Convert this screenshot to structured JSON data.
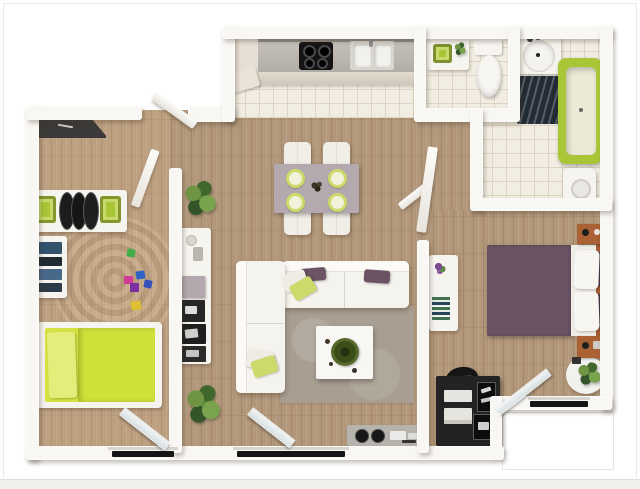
{
  "scene": {
    "kind": "3d-floor-plan-render",
    "description": "Top-down 3D render of a two-bedroom apartment floor plan with lime green and purple accents, wood flooring in living spaces and cream tile in kitchen, bathrooms and hallway. No text labels are rendered in the image.",
    "rooms": [
      {
        "name": "kitchen",
        "floor": "tile",
        "furniture": [
          "tall-cabinet",
          "range-hood",
          "counter",
          "cooktop-4-burner",
          "double-sink"
        ]
      },
      {
        "name": "bathroom-1",
        "floor": "tile",
        "furniture": [
          "vanity",
          "green-basin",
          "small-plant",
          "toilet"
        ]
      },
      {
        "name": "bathroom-2",
        "floor": "tile",
        "furniture": [
          "vanity",
          "round-sink",
          "dark-wave-bathmat",
          "lime-bathtub",
          "washer"
        ]
      },
      {
        "name": "hallway",
        "floor": "tile",
        "furniture": [
          "open-door-leaf",
          "leaning-door-leaf"
        ]
      },
      {
        "name": "living-dining",
        "floor": "wood",
        "furniture": [
          "dining-table",
          "dining-chairs-x4",
          "lime-plates-x4",
          "l-shaped-white-sofa",
          "purple-pillows",
          "lime-pillows",
          "coffee-table",
          "wreath-centerpiece",
          "area-rug",
          "media-console",
          "speakers",
          "shelf-column",
          "plants"
        ]
      },
      {
        "name": "bedroom-1-kids",
        "floor": "wood",
        "furniture": [
          "dark-wardrobe",
          "wall-shelf-green-bins",
          "side-shelf",
          "lime-bed",
          "toy-blocks",
          "round-rug",
          "balcony-glass-door"
        ]
      },
      {
        "name": "bedroom-2-master",
        "floor": "wood",
        "furniture": [
          "purple-double-bed",
          "white-pillows",
          "brown-nightstands",
          "desk",
          "black-dresser",
          "office-chair",
          "round-white-rug",
          "plant",
          "balcony-glass-door"
        ]
      }
    ]
  },
  "palette": {
    "wall": "#f9f7f3",
    "wood": "#b2977a",
    "wood_light": "#bfa385",
    "tile": "#f2ede2",
    "tile_line": "#ddd4c2",
    "lime": "#d5e342",
    "lime_dark": "#a9c636",
    "lime_soft": "#cdd96a",
    "purple": "#6b5365",
    "purple_deep": "#4e3e50",
    "mauve": "#b3a9ae",
    "taupe_rug": "#a89e91",
    "brown": "#a55e33",
    "dark": "#232323",
    "steel": "#b6b2ac",
    "plant_green": "#598538",
    "black": "#151515"
  }
}
